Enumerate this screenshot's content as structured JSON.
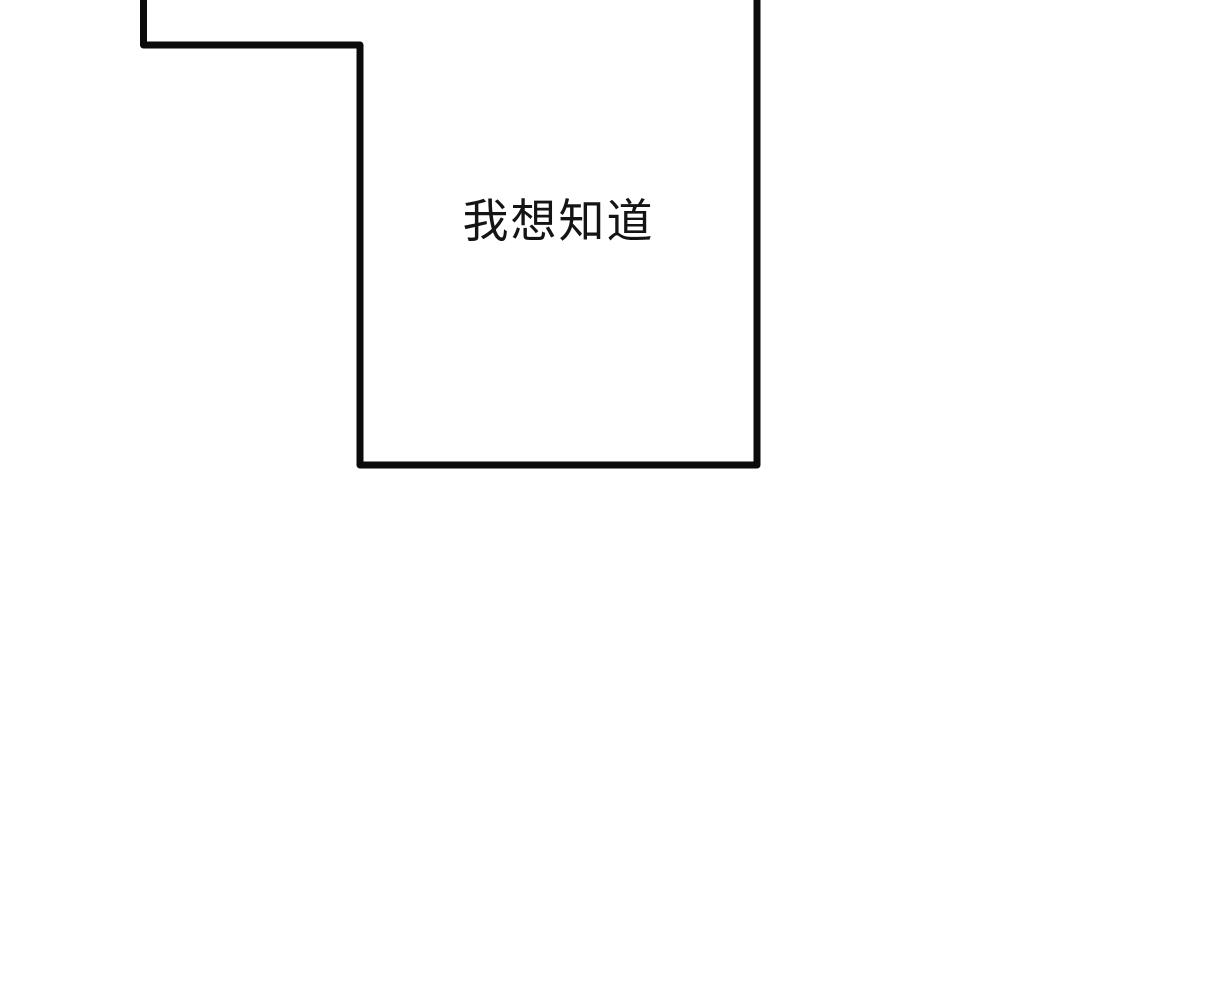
{
  "comic_panel": {
    "speech_text": "我想知道",
    "line_color": "#0b0b0b",
    "text_color": "#141414",
    "background_color": "#ffffff"
  }
}
